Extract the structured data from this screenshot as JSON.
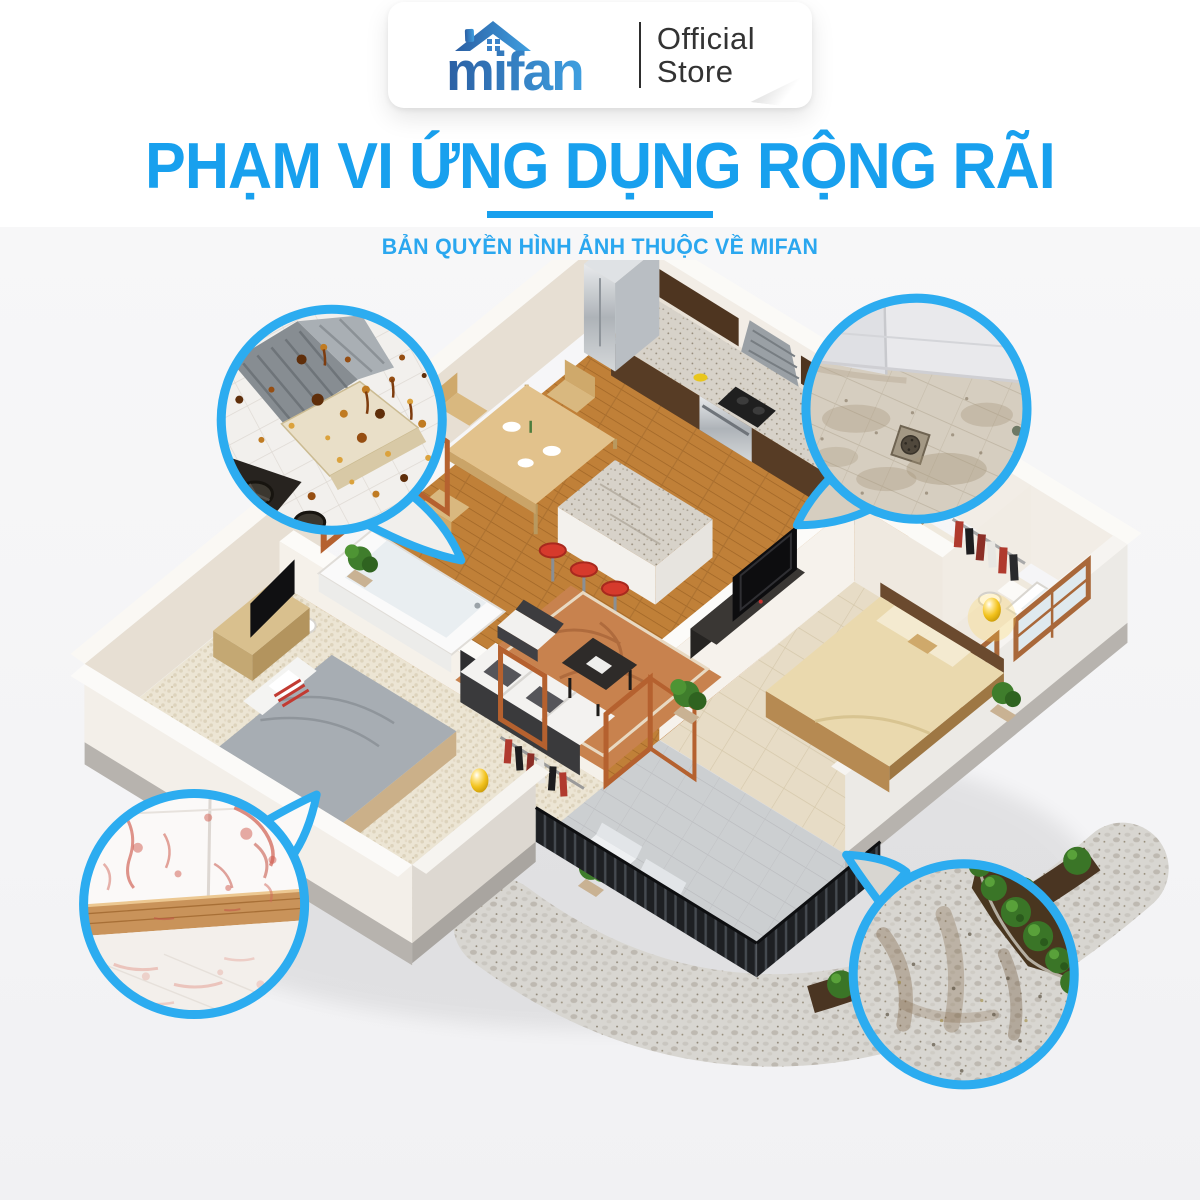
{
  "badge": {
    "logo_text": "mifan",
    "store_word1": "Official",
    "store_word2": "Store"
  },
  "heading": {
    "title": "PHẠM VI ỨNG DỤNG RỘNG RÃI",
    "subtitle": "BẢN QUYỀN HÌNH ẢNH THUỘC VỀ MIFAN"
  },
  "colors": {
    "accent_blue": "#18A0EE",
    "callout_border": "#2CACF0",
    "logo_blue_dark": "#2B5FA3",
    "logo_blue_light": "#3F9FE0",
    "store_text": "#333333",
    "background_gray": "#F5F5F7",
    "wood_floor": "#C08038",
    "lamp_gold": "#F2C21C"
  },
  "scene": {
    "kind": "isometric-3d-apartment-floorplan",
    "callouts": [
      {
        "id": "kitchen-hood",
        "icon": "dirty-range-hood-closeup-icon"
      },
      {
        "id": "bathroom-floor",
        "icon": "dirty-shower-floor-closeup-icon"
      },
      {
        "id": "wall-stains",
        "icon": "stained-wall-floor-closeup-icon"
      },
      {
        "id": "garden-path",
        "icon": "dirty-garden-path-closeup-icon"
      }
    ]
  }
}
